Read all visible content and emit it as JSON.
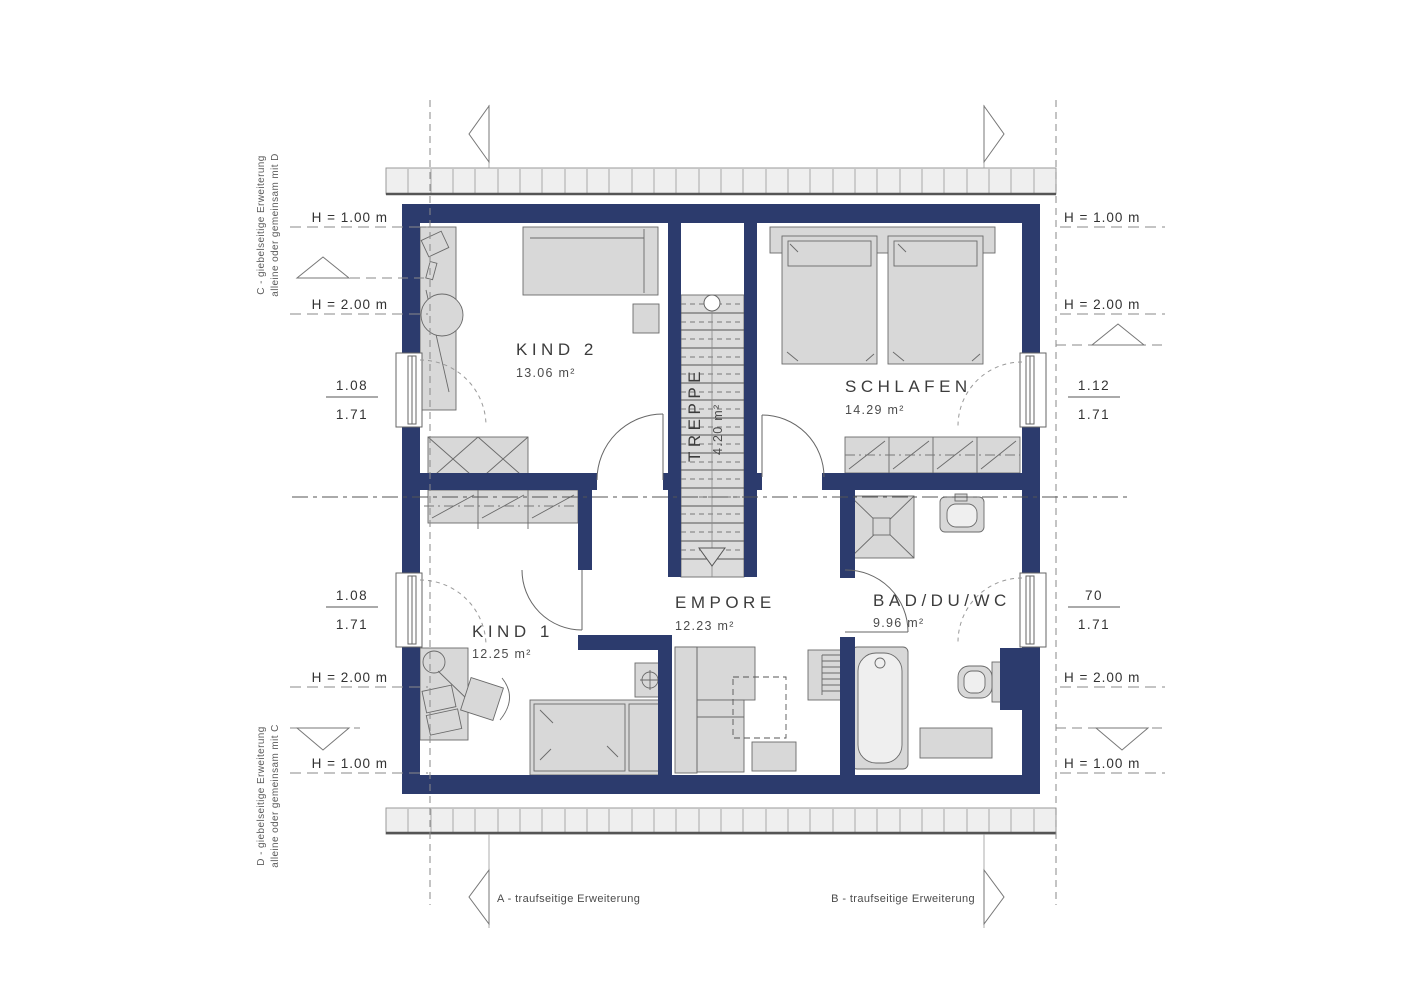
{
  "colors": {
    "wall": "#2c3b6d",
    "furniture": "#d8d8d8",
    "furniture_light": "#ececec",
    "roof_strip": "#efefef",
    "line": "#555555"
  },
  "rooms": [
    {
      "name": "KIND 2",
      "area": "13.06 m²"
    },
    {
      "name": "SCHLAFEN",
      "area": "14.29 m²"
    },
    {
      "name": "TREPPE",
      "area": "4.20 m²"
    },
    {
      "name": "KIND 1",
      "area": "12.25 m²"
    },
    {
      "name": "EMPORE",
      "area": "12.23 m²"
    },
    {
      "name": "BAD/DU/WC",
      "area": "9.96 m²"
    }
  ],
  "labels": {
    "h100": "H = 1.00 m",
    "h200": "H = 2.00 m"
  },
  "windows": {
    "left_top": {
      "num": "1.08",
      "den": "1.71"
    },
    "left_bottom": {
      "num": "1.08",
      "den": "1.71"
    },
    "right_top": {
      "num": "1.12",
      "den": "1.71"
    },
    "right_bottom": {
      "num": "70",
      "den": "1.71"
    }
  },
  "notes": {
    "c1": "C - giebelseitige Erweiterung",
    "c2": "alleine oder gemeinsam mit D",
    "d1": "D - giebelseitige Erweiterung",
    "d2": "alleine oder gemeinsam mit C",
    "a": "A - traufseitige Erweiterung",
    "b": "B - traufseitige Erweiterung"
  }
}
